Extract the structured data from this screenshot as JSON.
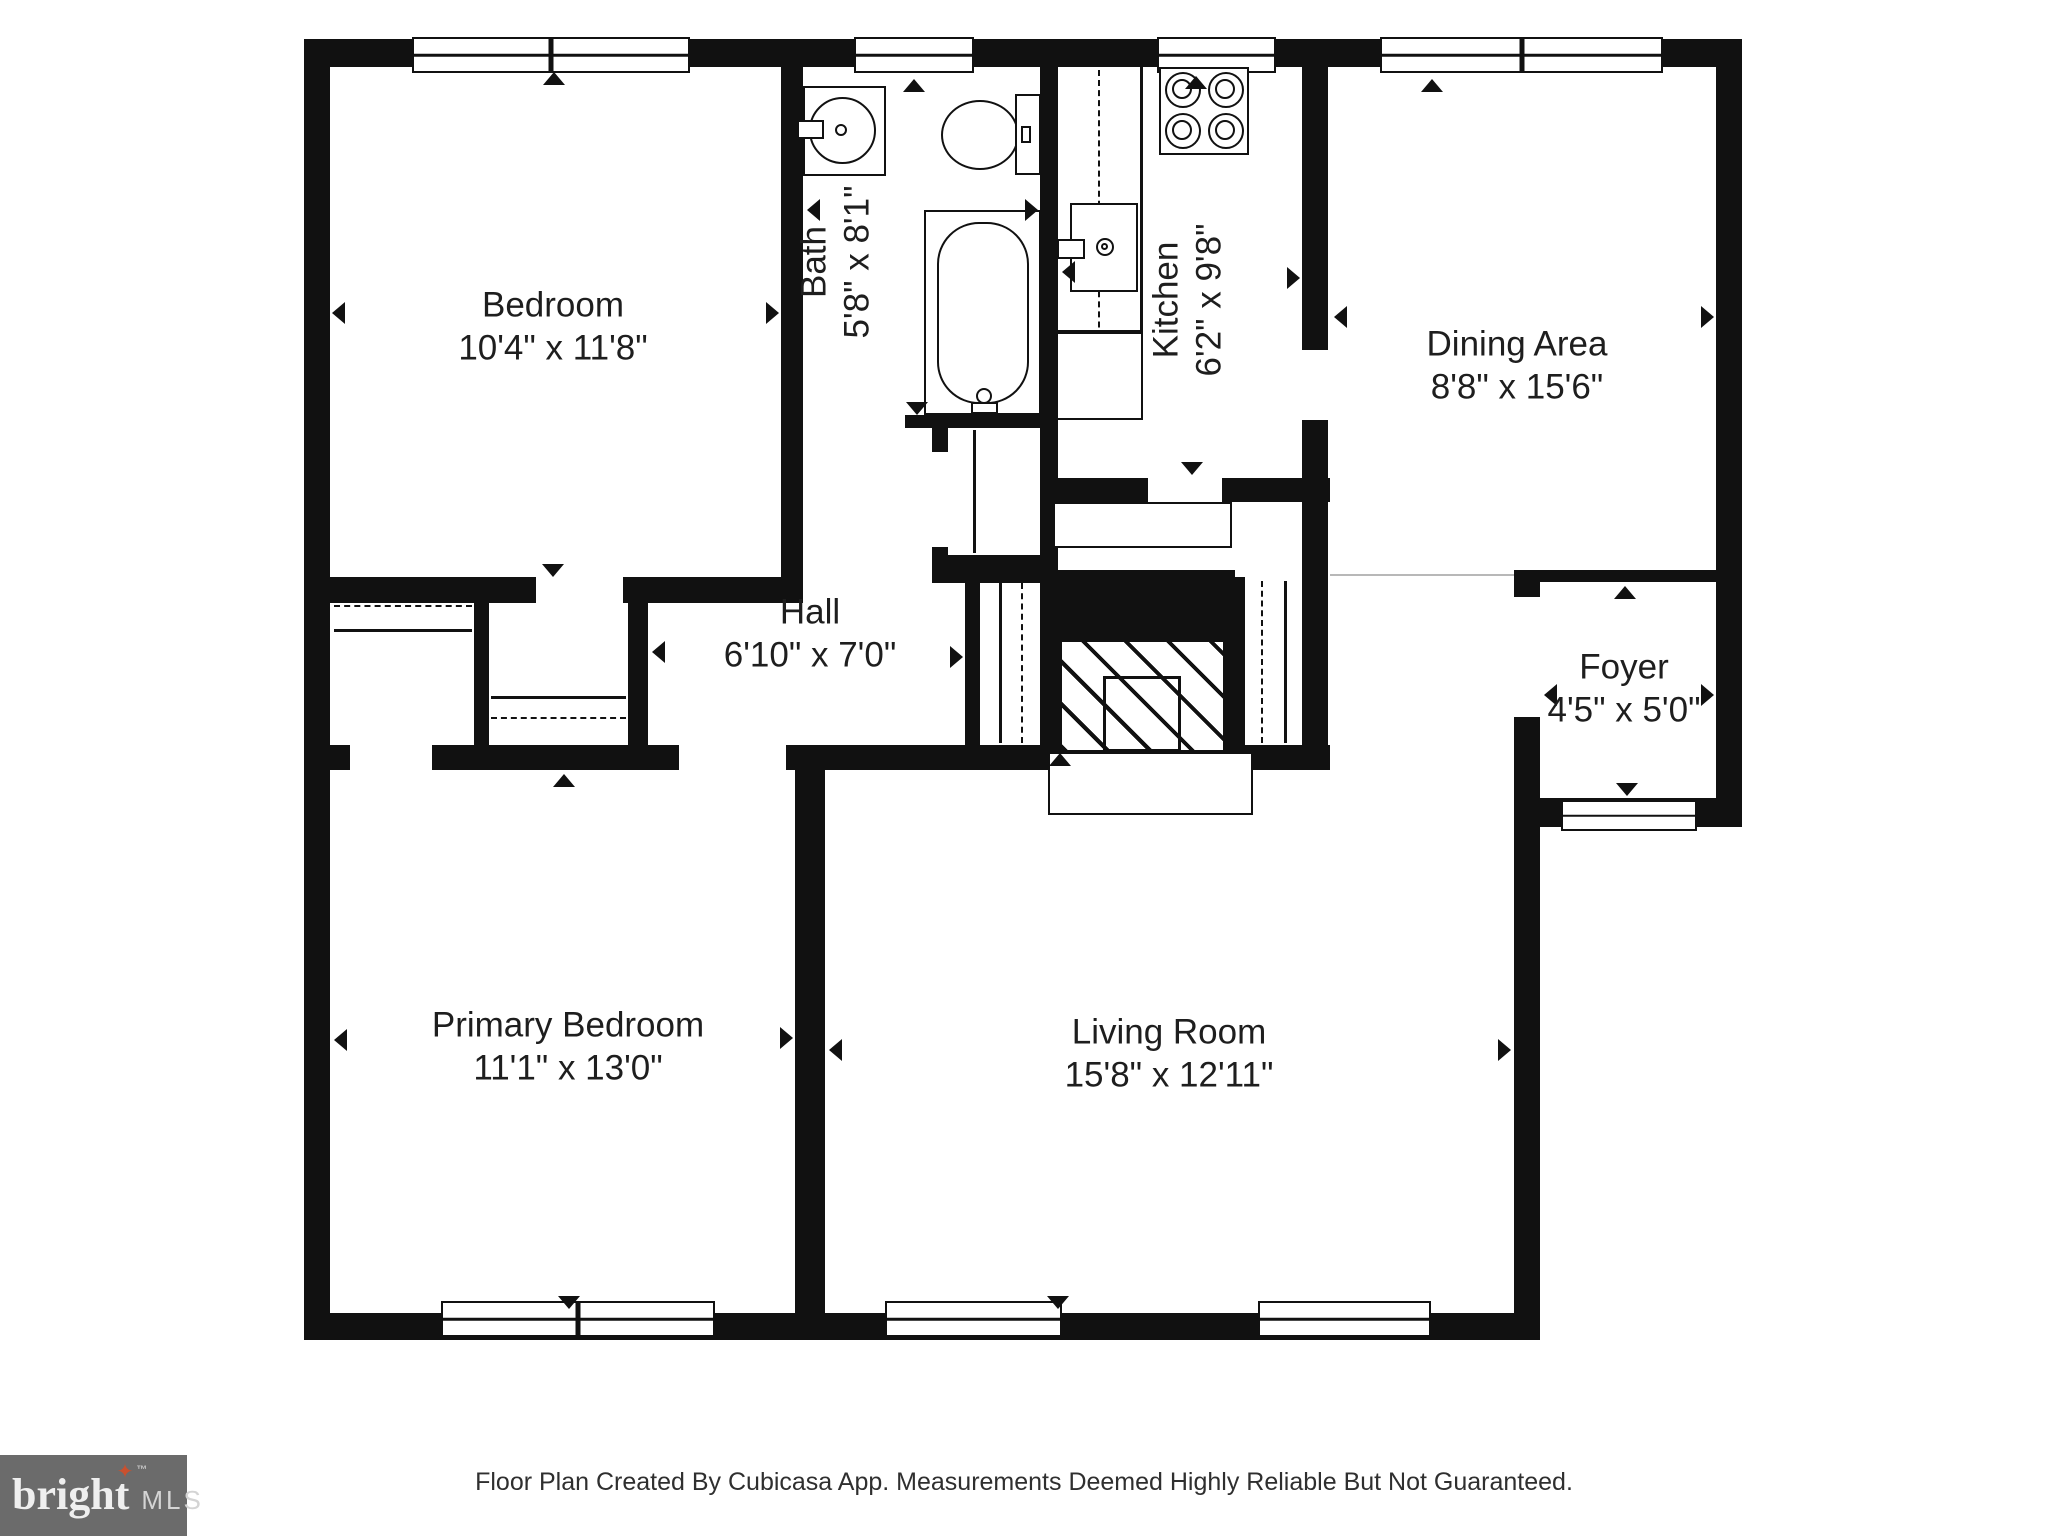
{
  "rooms": {
    "bedroom": {
      "name": "Bedroom",
      "dims": "10'4\" x 11'8\""
    },
    "bath": {
      "name": "Bath",
      "dims": "5'8\" x 8'1\""
    },
    "kitchen": {
      "name": "Kitchen",
      "dims": "6'2\" x 9'8\""
    },
    "dining_area": {
      "name": "Dining Area",
      "dims": "8'8\" x 15'6\""
    },
    "hall": {
      "name": "Hall",
      "dims": "6'10\" x 7'0\""
    },
    "foyer": {
      "name": "Foyer",
      "dims": "4'5\" x 5'0\""
    },
    "primary_bedroom": {
      "name": "Primary Bedroom",
      "dims": "11'1\" x 13'0\""
    },
    "living_room": {
      "name": "Living Room",
      "dims": "15'8\" x 12'11\""
    }
  },
  "footer": {
    "disclaimer": "Floor Plan Created By Cubicasa App. Measurements Deemed Highly Reliable But Not Guaranteed."
  },
  "logo": {
    "brand": "bright",
    "trademark": "™",
    "suffix": "MLS",
    "star_glyph": "✦"
  },
  "colors": {
    "wall": "#111111",
    "logo_background": "#6b6b6b",
    "logo_star": "#c9502e",
    "logo_text": "#efefef",
    "label_text": "#1e1e1e",
    "disclaimer_text": "#2f2f2f"
  }
}
